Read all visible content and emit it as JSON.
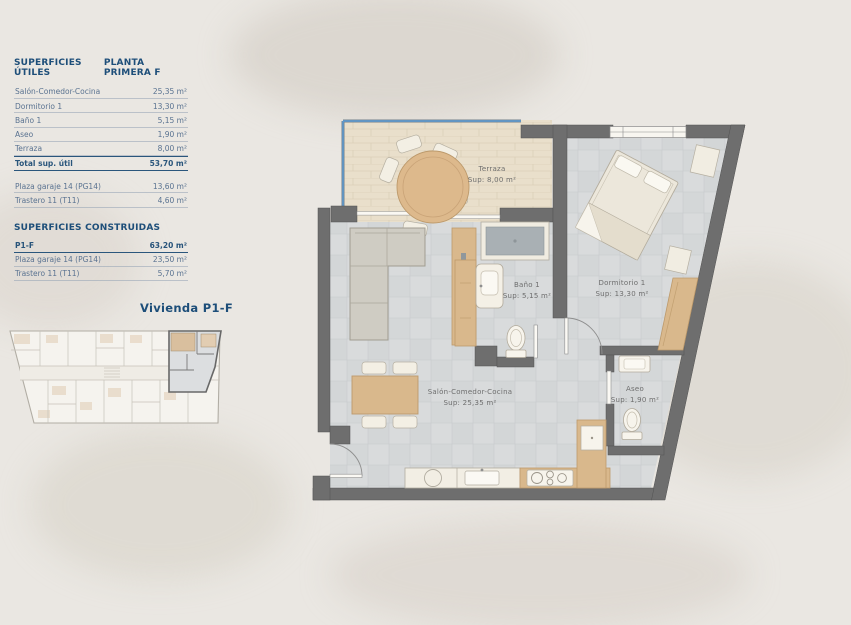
{
  "panel": {
    "title_left": "SUPERFICIES ÚTILES",
    "title_right": "PLANTA PRIMERA F",
    "useful_rows": [
      {
        "label": "Salón-Comedor-Cocina",
        "value": "25,35 m²"
      },
      {
        "label": "Dormitorio 1",
        "value": "13,30 m²"
      },
      {
        "label": "Baño 1",
        "value": "5,15 m²"
      },
      {
        "label": "Aseo",
        "value": "1,90 m²"
      },
      {
        "label": "Terraza",
        "value": "8,00 m²"
      }
    ],
    "total_row": {
      "label": "Total sup. útil",
      "value": "53,70 m²"
    },
    "annex_rows": [
      {
        "label": "Plaza garaje 14 (PG14)",
        "value": "13,60 m²"
      },
      {
        "label": "Trastero 11 (T11)",
        "value": "4,60 m²"
      }
    ],
    "built_title": "SUPERFICIES CONSTRUIDAS",
    "built_rows": [
      {
        "label": "P1-F",
        "value": "63,20 m²"
      },
      {
        "label": "Plaza garaje 14 (PG14)",
        "value": "23,50 m²"
      },
      {
        "label": "Trastero 11 (T11)",
        "value": "5,70 m²"
      }
    ]
  },
  "mini_plan": {
    "label": "Vivienda P1-F"
  },
  "floor_plan": {
    "rooms": [
      {
        "name": "Terraza",
        "sup": "Sup: 8,00 m²"
      },
      {
        "name": "Dormitorio 1",
        "sup": "Sup: 13,30 m²"
      },
      {
        "name": "Baño 1",
        "sup": "Sup: 5,15 m²"
      },
      {
        "name": "Salón-Comedor-Cocina",
        "sup": "Sup: 25,35 m²"
      },
      {
        "name": "Aseo",
        "sup": "Sup: 1,90 m²"
      }
    ]
  },
  "colors": {
    "accent_navy": "#1d4e79",
    "row_text_blue": "#5a7391",
    "wall_gray": "#6e6e6e",
    "tile_floor": "#d9dbdc",
    "terrace_floor": "#e9dfcb",
    "wood": "#d9b88c",
    "furniture_cream": "#f1ede2",
    "sofa_gray": "#cfccc3",
    "railing_blue": "#5b9bd5",
    "background": "#eae7e2",
    "plan_label_gray": "#6e6e6e"
  }
}
